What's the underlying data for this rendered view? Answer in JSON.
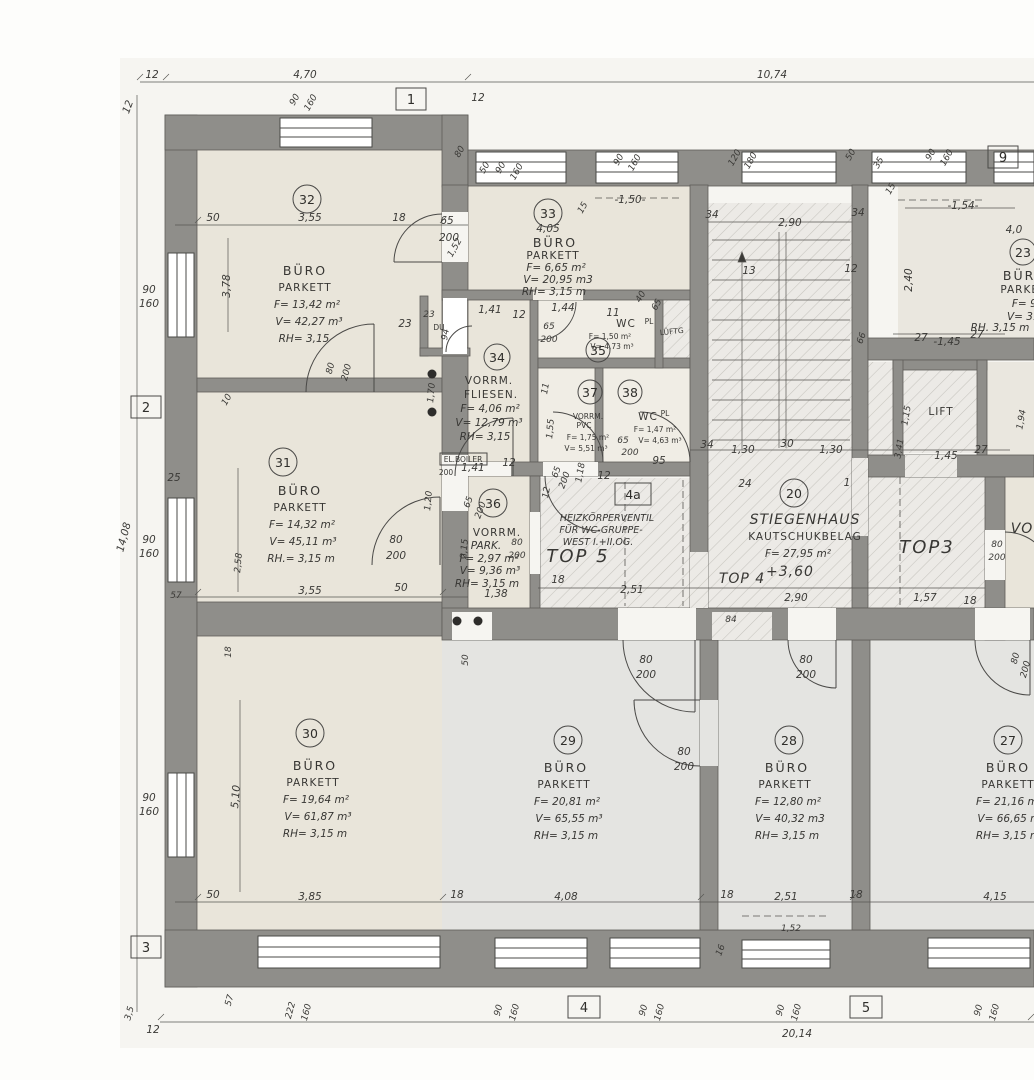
{
  "drawing": {
    "type": "floor-plan",
    "language": "de"
  },
  "colors": {
    "wall": "#8f8e8a",
    "beige_room": "#e9e5da",
    "gray_room": "#e4e4e1",
    "hatch_bg": "#eceae6",
    "hatch_line": "#c6c4be",
    "paper": "#f6f5f1",
    "ink": "#3b3a37"
  },
  "grid": {
    "g1": "1",
    "g2": "2",
    "g3": "3",
    "g4": "4",
    "g5": "5",
    "g9": "9"
  },
  "rooms": {
    "r32": {
      "num": "32",
      "name": "BÜRO",
      "floor": "PARKETT",
      "f": "F= 13,42 m²",
      "v": "V= 42,27 m³",
      "rh": "RH= 3,15"
    },
    "r31": {
      "num": "31",
      "name": "BÜRO",
      "floor": "PARKETT",
      "f": "F= 14,32 m²",
      "v": "V= 45,11 m³",
      "rh": "RH.= 3,15 m"
    },
    "r30": {
      "num": "30",
      "name": "BÜRO",
      "floor": "PARKETT",
      "f": "F= 19,64 m²",
      "v": "V= 61,87 m³",
      "rh": "RH= 3,15 m"
    },
    "r33": {
      "num": "33",
      "name": "BÜRO",
      "floor": "PARKETT",
      "f": "F= 6,65 m²",
      "v": "V= 20,95 m3",
      "rh": "RH= 3,15 m"
    },
    "r34": {
      "num": "34",
      "name": "VORRM.",
      "floor": "FLIESEN.",
      "f": "F= 4,06 m²",
      "v": "V= 12,79 m³",
      "rh": "RH= 3,15"
    },
    "r35": {
      "num": "35",
      "name": "WC",
      "floor": "PL",
      "f": "F= 1,50 m²",
      "v": "V= 4,73 m³"
    },
    "r36": {
      "num": "36",
      "name": "VORRM.",
      "floor": "PARK.",
      "f": "F= 2,97 m²",
      "v": "V= 9,36 m³",
      "rh": "RH= 3,15 m"
    },
    "r37": {
      "num": "37",
      "name": "VORRM.",
      "floor": "PVC",
      "f": "F= 1,75 m²",
      "v": "V= 5,51 m³"
    },
    "r38": {
      "num": "38",
      "name": "WC",
      "floor": "PL",
      "f": "F= 1,47 m²",
      "v": "V= 4,63 m³"
    },
    "r20": {
      "num": "20",
      "name": "STIEGENHAUS",
      "floor": "KAUTSCHUKBELAG",
      "f": "F= 27,95 m²",
      "level": "+3,60"
    },
    "r29": {
      "num": "29",
      "name": "BÜRO",
      "floor": "PARKETT",
      "f": "F= 20,81 m²",
      "v": "V= 65,55 m³",
      "rh": "RH= 3,15 m"
    },
    "r28": {
      "num": "28",
      "name": "BÜRO",
      "floor": "PARKETT",
      "f": "F= 12,80 m²",
      "v": "V= 40,32 m3",
      "rh": "RH= 3,15 m"
    },
    "r27": {
      "num": "27",
      "name": "BÜRO",
      "floor": "PARKETT",
      "f": "F= 21,16 m²",
      "v": "V= 66,65 m³",
      "rh": "RH= 3,15 m"
    },
    "r23": {
      "num": "23",
      "name": "BÜRO",
      "floor": "PARKETT",
      "f": "F= 9,",
      "v": "V= 31,",
      "rh": "RH. 3,15 m"
    }
  },
  "areas": {
    "top5": "TOP 5",
    "top4": "TOP 4",
    "top3": "TOP3",
    "lift": "LIFT",
    "vo": "VO"
  },
  "note4a": {
    "tag": "4a",
    "l1": "HEIZKÖRPERVENTIL",
    "l2": "FÜR WC-GRUPPE-",
    "l3": "WEST I.+II.OG."
  },
  "labels": {
    "du": "DU",
    "el_boiler": "EL.BOILER",
    "el_boiler2": "200",
    "lueftg": "LÜFTG"
  },
  "dims": {
    "t12a": "12",
    "t470": "4,70",
    "t1074": "10,74",
    "t12b": "12",
    "t90a": "90",
    "t160a": "160",
    "t12c": "12",
    "t80a": "80",
    "t50a": "50",
    "t90b": "90",
    "t160b": "160",
    "t15a": "15",
    "t150": "-1,50-",
    "t90c": "90",
    "t160c": "160",
    "t120": "120",
    "t180": "180",
    "t50b": "50",
    "t35a": "35",
    "t90d": "90",
    "t160d": "160",
    "t15b": "15",
    "a50": "50",
    "a355": "3,55",
    "a18": "18",
    "a65": "65",
    "a200": "200",
    "a152": "1,52",
    "a378": "3,78",
    "a23": "23",
    "a80": "80",
    "a200b": "200",
    "a405": "4,05",
    "b141": "1,41",
    "b12": "12",
    "b94": "94",
    "b23": "23",
    "b144": "1,44",
    "b11": "11",
    "b65": "65",
    "b200": "200",
    "b40": "40",
    "b65b": "65",
    "c170": "1,70",
    "c141": "1,41",
    "c12": "12",
    "c120": "1,20",
    "c65": "65",
    "c200": "200",
    "d11": "11",
    "d155": "1,55",
    "d118": "1,18",
    "d12": "12",
    "d65": "65",
    "d200": "200",
    "d65b": "65",
    "d200b": "200",
    "d95": "95",
    "s34a": "34",
    "s290a": "2,90",
    "s34b": "34",
    "s13": "13",
    "s12": "12",
    "s66": "66",
    "s34c": "34",
    "s130a": "1,30",
    "s30": "30",
    "s130b": "1,30",
    "s24": "24",
    "s1": "1",
    "s290b": "2,90",
    "s84": "84",
    "r154": "-1,54-",
    "r40": "4,0",
    "r240": "2,40",
    "r27a": "27",
    "r145a": "-1,45",
    "r27b": "27",
    "r115": "1,15",
    "r341": "3,41",
    "r145b": "1,45",
    "r27c": "27",
    "r194": "1,94",
    "r80": "80",
    "r200": "200",
    "r157": "1,57",
    "r18": "18",
    "m12": "12",
    "m18": "18",
    "m251": "2,51",
    "e215": "2,15",
    "e138": "1,38",
    "e80": "80",
    "e200": "200",
    "f355": "3,55",
    "f50": "50",
    "f80": "80",
    "f200": "200",
    "L90a": "90",
    "L160a": "160",
    "L10": "10",
    "L25": "25",
    "L1408": "14,08",
    "L90b": "90",
    "L160b": "160",
    "L258": "2,58",
    "L57": "57",
    "L18": "18",
    "L90c": "90",
    "L160c": "160",
    "L510": "5,10",
    "L35": "3,5",
    "L12": "12",
    "g50": "50",
    "g385": "3,85",
    "g18a": "18",
    "g408": "4,08",
    "g18b": "18",
    "g251": "2,51",
    "g18c": "18",
    "g415": "4,15",
    "g152": "1,52",
    "g16": "16",
    "g57": "57",
    "g222": "222",
    "g160a": "160",
    "g90a": "90",
    "g160b": "160",
    "g90b": "90",
    "g160c": "160",
    "g90c": "90",
    "g160d": "160",
    "g90d": "90",
    "g160e": "160",
    "g2014": "20,14",
    "g50b": "50",
    "h80a": "80",
    "h200a": "200",
    "h80b": "80",
    "h200b": "200",
    "h80c": "80",
    "h200c": "200",
    "h80d": "80",
    "h200d": "200"
  }
}
